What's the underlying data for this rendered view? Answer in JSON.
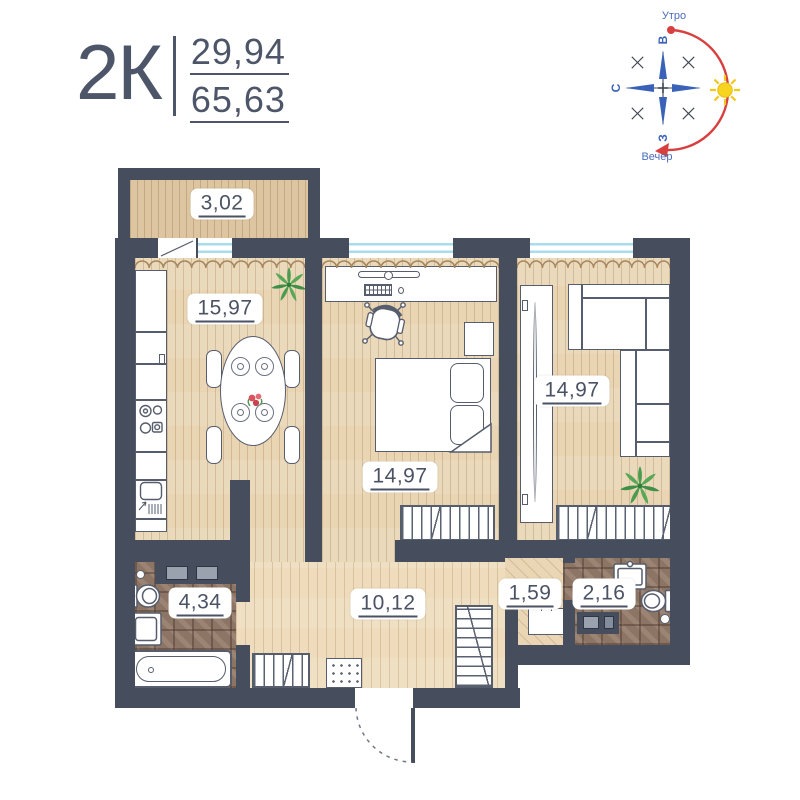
{
  "header": {
    "apartment_type": "2К",
    "value_top": "29,94",
    "value_bottom": "65,63"
  },
  "compass": {
    "morning": "Утро",
    "evening": "Вечер",
    "east": "В",
    "north": "С",
    "west": "З",
    "arc_color": "#d84040",
    "pointer_color": "#3a63b8",
    "sun_color": "#f6d41f",
    "label_color": "#4a6db9"
  },
  "rooms": {
    "balcony": {
      "name": "balcony",
      "area": "3,02"
    },
    "kitchen_living": {
      "name": "kitchen-living",
      "area": "15,97"
    },
    "bedroom": {
      "name": "bedroom",
      "area": "14,97"
    },
    "living": {
      "name": "living-room",
      "area": "14,97"
    },
    "hallway": {
      "name": "hallway",
      "area": "10,12"
    },
    "bathroom": {
      "name": "bathroom",
      "area": "4,34"
    },
    "storage": {
      "name": "storage",
      "area": "1,59"
    },
    "wc": {
      "name": "wc",
      "area": "2,16"
    }
  },
  "furniture": {
    "kitchen_living": [
      "fridge-counter",
      "stove",
      "kitchen-sink",
      "dining-table",
      "chairs",
      "plant",
      "flowers"
    ],
    "bedroom": [
      "desk",
      "monitor",
      "keyboard",
      "mouse",
      "office-chair",
      "bed",
      "pillows",
      "nightstand",
      "wardrobe-rail"
    ],
    "living": [
      "wardrobe",
      "corner-sofa",
      "wardrobe-rail",
      "plant"
    ],
    "hallway": [
      "shelf-closet",
      "shoe-rack",
      "doormat",
      "entrance-door"
    ],
    "bathroom": [
      "counter-appliances",
      "toilet",
      "washbasin",
      "bathtub"
    ],
    "wc": [
      "washbasin",
      "toilet",
      "washing-machine"
    ],
    "storage": [
      "cabinet"
    ]
  },
  "colors": {
    "wall": "#464d5c",
    "wood_floor": "#e9d5b4",
    "balcony_floor": "#dcc5a0",
    "tile_floor": "#8d7566",
    "window_glass": "#a8dcec",
    "curtain": "#a5855c",
    "text": "#4a5264",
    "plant_green": "#4c9b4f",
    "flower_red": "#d9525e"
  }
}
